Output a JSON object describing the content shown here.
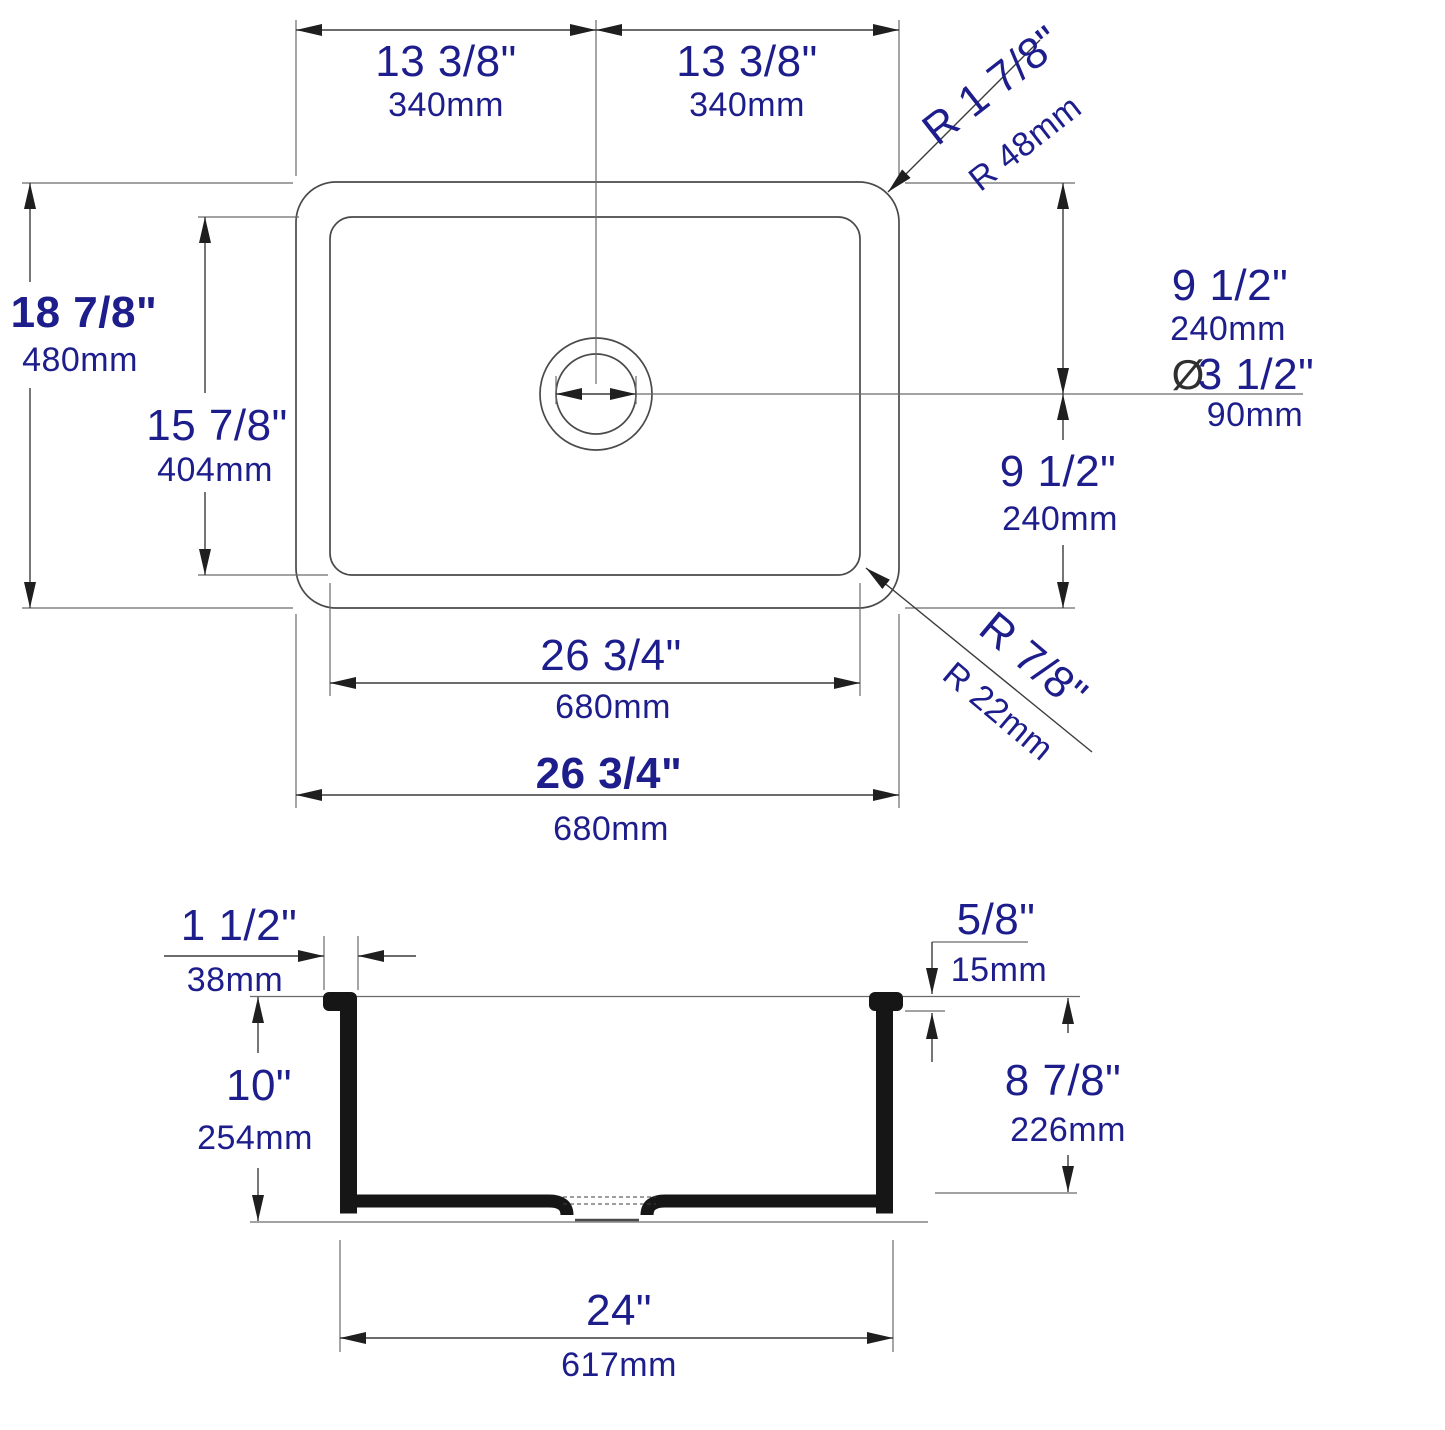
{
  "title": "Sink technical dimension drawing",
  "colors": {
    "dimension_text": "#1d1d8c",
    "drawing_line": "#4a4a4a",
    "solid_section": "#161616"
  },
  "plan": {
    "half_width_left": {
      "in": "13 3/8\"",
      "mm": "340mm"
    },
    "half_width_right": {
      "in": "13 3/8\"",
      "mm": "340mm"
    },
    "outer_corner_radius": {
      "in": "R 1 7/8\"",
      "mm": "R 48mm"
    },
    "overall_depth": {
      "in": "18 7/8\"",
      "mm": "480mm"
    },
    "bowl_depth": {
      "in": "15 7/8\"",
      "mm": "404mm"
    },
    "back_to_drain": {
      "in": "9 1/2\"",
      "mm": "240mm"
    },
    "drain_to_front": {
      "in": "9 1/2\"",
      "mm": "240mm"
    },
    "drain_diameter": {
      "symbol": "Ø",
      "in": "3 1/2\"",
      "mm": "90mm"
    },
    "inner_corner_radius": {
      "in": "R 7/8\"",
      "mm": "R 22mm"
    },
    "bowl_width": {
      "in": "26 3/4\"",
      "mm": "680mm"
    },
    "overall_width": {
      "in": "26 3/4\"",
      "mm": "680mm"
    }
  },
  "section": {
    "rim_width": {
      "in": "1 1/2\"",
      "mm": "38mm"
    },
    "overall_height": {
      "in": "10\"",
      "mm": "254mm"
    },
    "rim_thickness": {
      "in": "5/8\"",
      "mm": "15mm"
    },
    "bowl_height": {
      "in": "8 7/8\"",
      "mm": "226mm"
    },
    "base_width": {
      "in": "24\"",
      "mm": "617mm"
    }
  }
}
